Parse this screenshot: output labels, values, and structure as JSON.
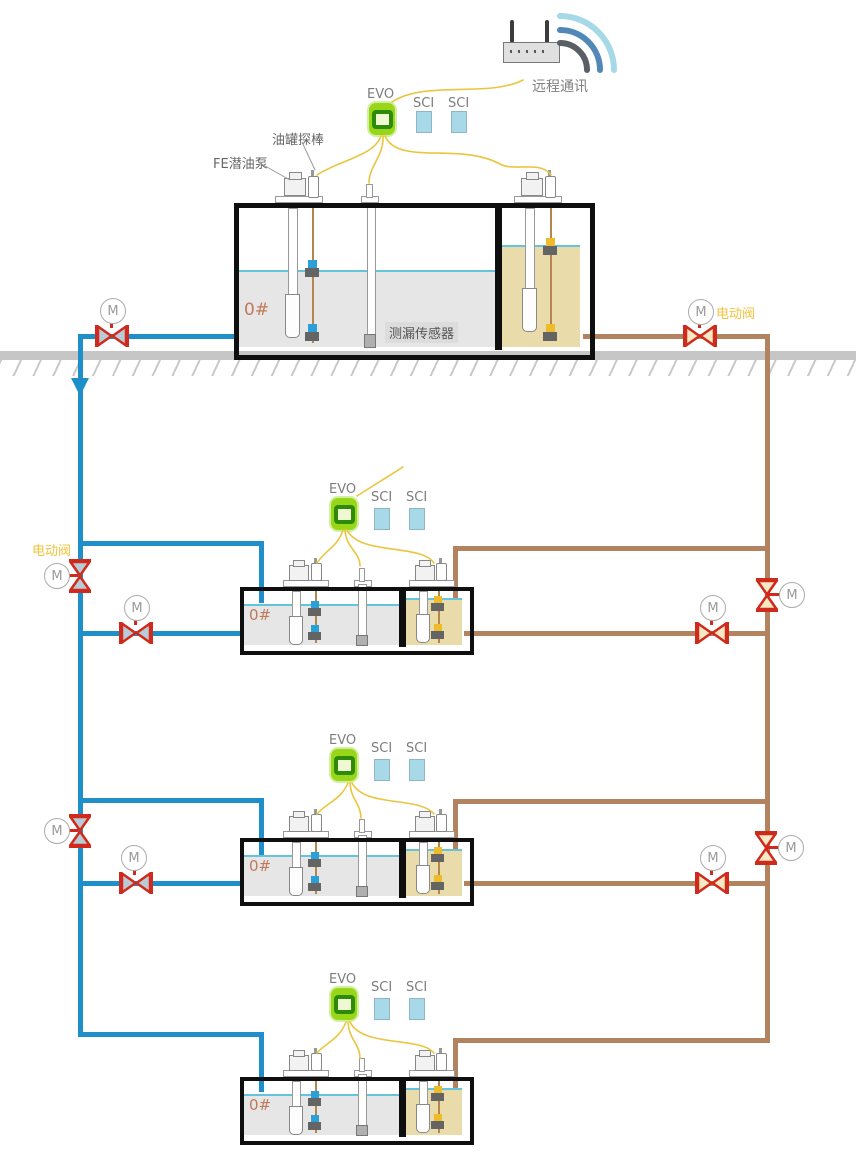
{
  "communication": {
    "label": "远程通讯"
  },
  "station": {
    "console_label": "EVO",
    "module_label": "SCI"
  },
  "tank1": {
    "grade": "0#",
    "pump_label": "FE潜油泵",
    "probe_label": "油罐探棒",
    "leak_sensor_label": "测漏传感器"
  },
  "tank_row": {
    "grade": "0#"
  },
  "valves": {
    "motor_symbol": "M",
    "electric_valve_label": "电动阀"
  },
  "colors": {
    "diesel_pipe": "#1f8fc9",
    "gasoline_pipe": "#b3825e",
    "valve_red": "#cf2a1c",
    "valve_fill_diesel": "#b9ccd6",
    "valve_fill_gas": "#f6e9c3",
    "evo_green": "#97d619",
    "evo_ring": "#2e8b06",
    "sci_blue": "#a7d9e8",
    "wire_yellow": "#e9c63f",
    "diesel_fill": "#e6e6e6",
    "gasoline_fill": "#e9dcaa",
    "liquid_line": "#63c4dc",
    "grade_orange": "#c0795a",
    "valve_label_yellow": "#f0c23c",
    "ground_gray": "#c6c6c6",
    "tank_border": "#0f0f0f",
    "wifi_outer": "#a5d9e8",
    "wifi_mid": "#5188b8",
    "wifi_inner": "#5a5f66"
  }
}
